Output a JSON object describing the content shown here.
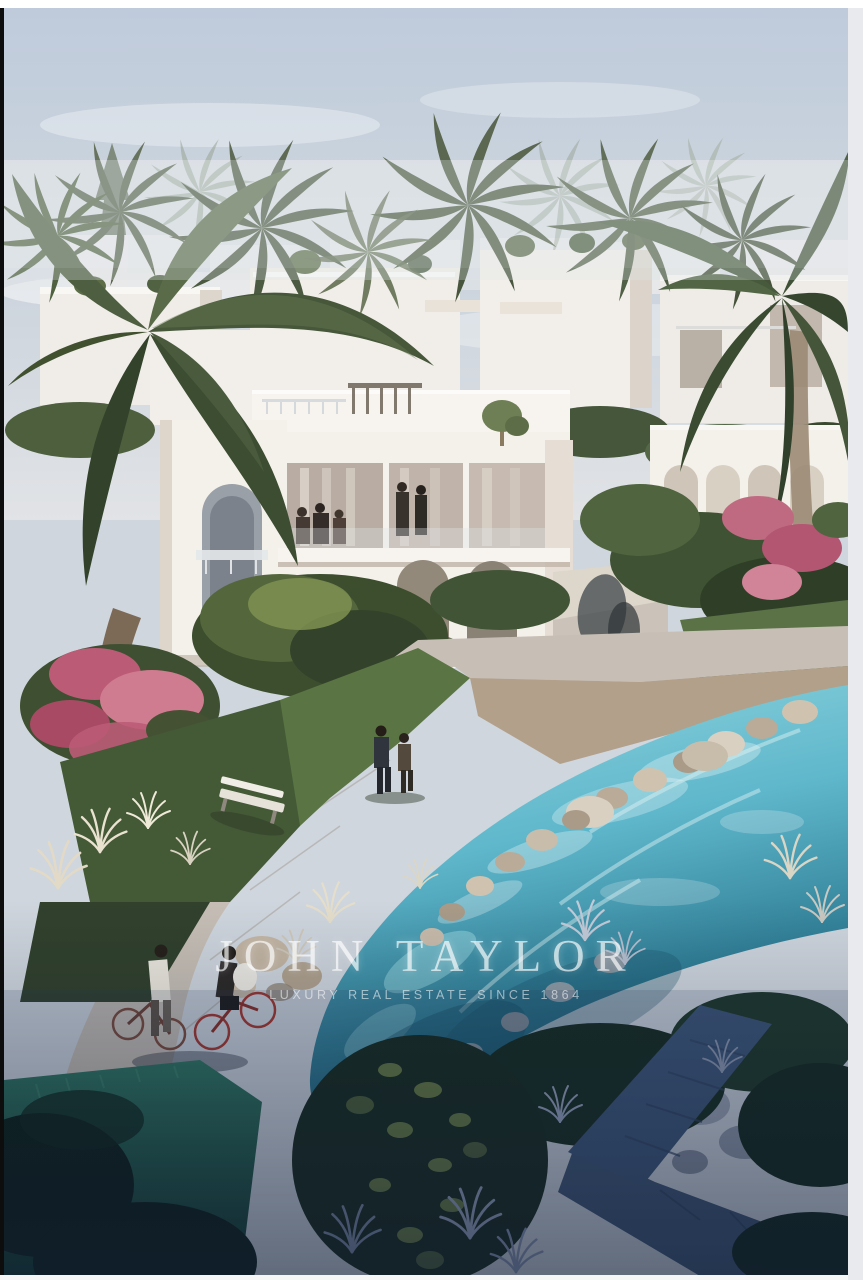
{
  "watermark": {
    "brand": "JOHN TAYLOR",
    "tagline": "LUXURY REAL ESTATE SINCE 1864",
    "text_color": "#ffffff"
  },
  "frame": {
    "top_color": "#ffffff",
    "left_color": "#0d0d0d",
    "right_color": "#e9eaee",
    "bottom_color": "#f6f6f6"
  },
  "palette": {
    "sky_top": "#b9c6d7",
    "sky_horizon": "#e0e2e5",
    "villa_white": "#f4f0ea",
    "villa_shadow": "#d8d0c7",
    "palm_green": "#4c5e3d",
    "palm_dark": "#39492f",
    "garden_green": "#435634",
    "flower_pink": "#c2637e",
    "lawn_green": "#5d7746",
    "water_turquoise": "#72c4d5",
    "water_deep": "#27657d",
    "path_light": "#c7bfb6",
    "gravel_tan": "#b2a08b",
    "rock_beige": "#c8bcab",
    "shadow_path_blue": "#3d5474",
    "night_green": "#14291c"
  }
}
